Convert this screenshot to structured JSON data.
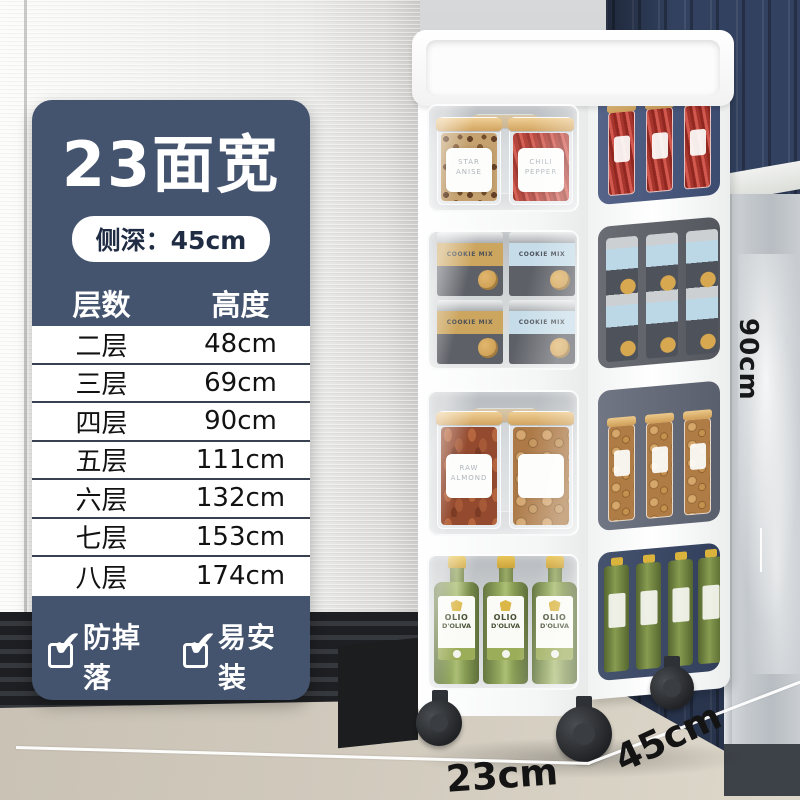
{
  "panel": {
    "title": "23面宽",
    "depth_badge": "侧深：45cm",
    "table": {
      "headers": [
        "层数",
        "高度"
      ],
      "rows": [
        {
          "layers": "二层",
          "height": "48cm"
        },
        {
          "layers": "三层",
          "height": "69cm"
        },
        {
          "layers": "四层",
          "height": "90cm"
        },
        {
          "layers": "五层",
          "height": "111cm"
        },
        {
          "layers": "六层",
          "height": "132cm"
        },
        {
          "layers": "七层",
          "height": "153cm"
        },
        {
          "layers": "八层",
          "height": "174cm"
        }
      ]
    },
    "features": [
      "防掉落",
      "易安装",
      "质量好",
      "强承重"
    ]
  },
  "dimensions": {
    "height": "90cm",
    "width": "23cm",
    "depth": "45cm"
  },
  "product": {
    "tier1": {
      "jar1_label": "STAR ANISE",
      "jar2_label": "CHILI PEPPER"
    },
    "tier2": {
      "can_label": "COOKIE MIX"
    },
    "tier3": {
      "jar1_label": "RAW ALMOND",
      "jar2_label": ""
    },
    "tier4": {
      "label_line1": "OLIO",
      "label_line2": "D'OLIVA"
    }
  },
  "icons": {
    "check": "✔"
  },
  "colors": {
    "panel_navy": "#44536E",
    "wall_navy": "#32415F",
    "floor_beige": "#CEC7BA",
    "accent_white": "#FFFFFF"
  }
}
